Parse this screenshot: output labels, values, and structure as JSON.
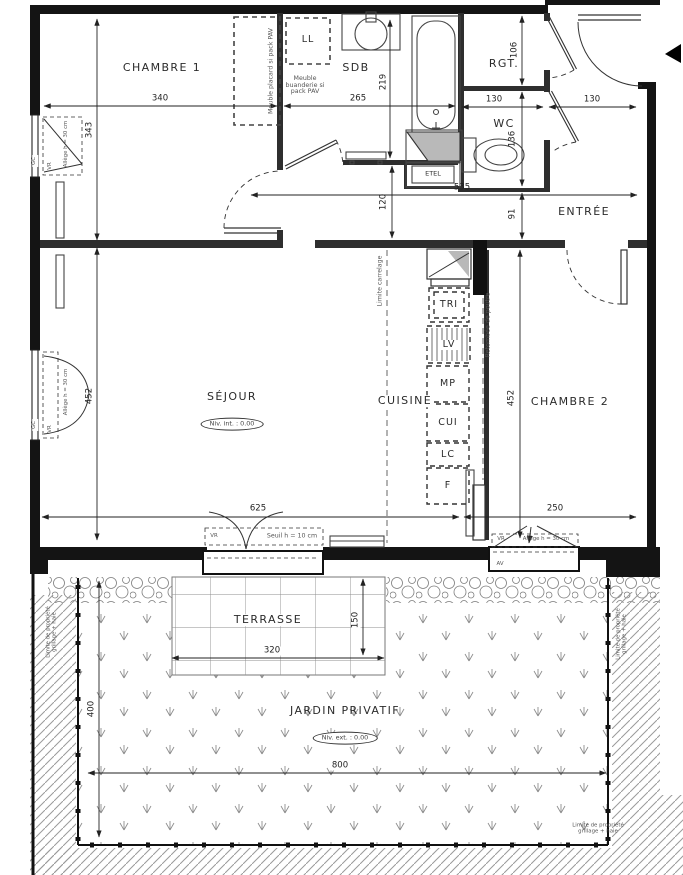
{
  "rooms": {
    "chambre1": "CHAMBRE 1",
    "sdb": "SDB",
    "rgt": "RGT.",
    "wc": "WC",
    "entree": "ENTRÉE",
    "sejour": "SÉJOUR",
    "cuisine": "CUISINE",
    "chambre2": "CHAMBRE 2",
    "terrasse": "TERRASSE",
    "jardin": "JARDIN PRIVATIF"
  },
  "levels": {
    "interior": "Niv. int. : 0.00",
    "exterior": "Niv. ext. : 0.00"
  },
  "equipment": {
    "ll": "LL",
    "etel": "ETEL",
    "tri": "TRI",
    "lv": "LV",
    "mp": "MP",
    "cui": "CUI",
    "lc": "LC",
    "f": "F"
  },
  "notes": {
    "meuble_buanderie_1": "Meuble",
    "meuble_buanderie_2": "buanderie si",
    "meuble_buanderie_3": "pack PAV",
    "meuble_placard": "Meuble placard si pack PAV",
    "limite_carrelage": "Limite carrelage",
    "retombee_poutre": "Retombée de poutre",
    "seuil": "Seuil h = 10 cm",
    "allege": "Allège h = 30 cm",
    "vr": "VR",
    "gc": "GC",
    "av": "AV",
    "limite_propriete": "Limite de propriété",
    "grillage_haie": "grillage + haie"
  },
  "dimensions_cm": {
    "chambre1_width": "340",
    "chambre1_height": "343",
    "sdb_width": "265",
    "sdb_height": "219",
    "rgt_width": "130",
    "entree_width": "130",
    "rgt_height": "106",
    "wc_height": "136",
    "hall_length": "535",
    "hall_width": "120",
    "entree_depth": "91",
    "sejour_height": "452",
    "chambre2_height": "452",
    "sejour_width": "625",
    "chambre2_width": "250",
    "terrasse_width": "320",
    "terrasse_depth": "150",
    "jardin_depth": "400",
    "jardin_width": "800"
  }
}
